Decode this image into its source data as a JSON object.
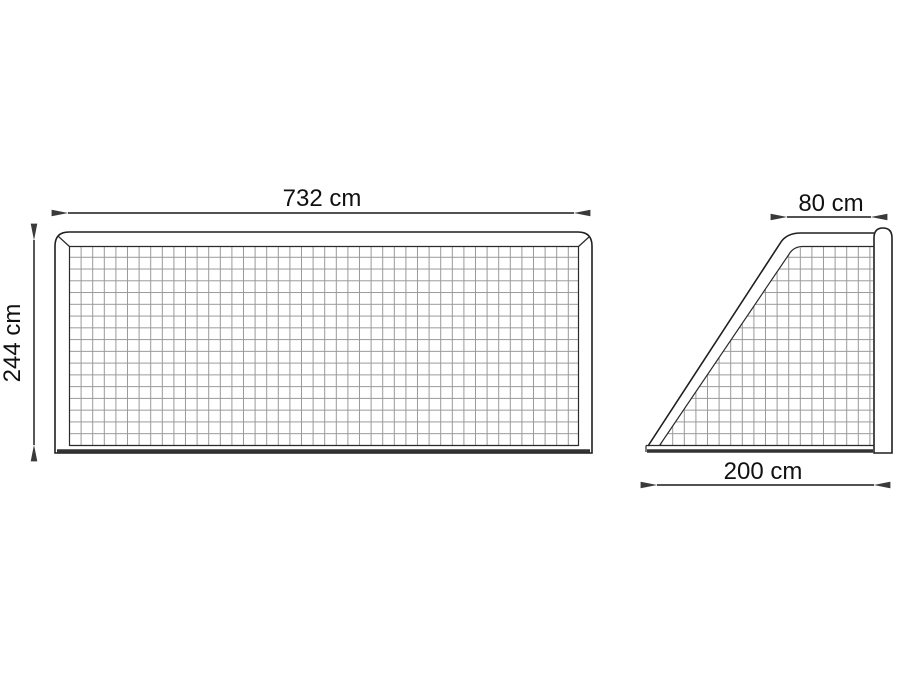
{
  "diagram": {
    "kind": "technical-drawing",
    "front": {
      "width_label": "732 cm",
      "height_label": "244 cm"
    },
    "side": {
      "depth_top_label": "80 cm",
      "depth_bottom_label": "200 cm"
    },
    "colors": {
      "background": "#ffffff",
      "frame": "#1f1f1f",
      "net_grid": "#999999",
      "dimension": "#3a3a3a",
      "ground_bar": "#333333"
    }
  }
}
